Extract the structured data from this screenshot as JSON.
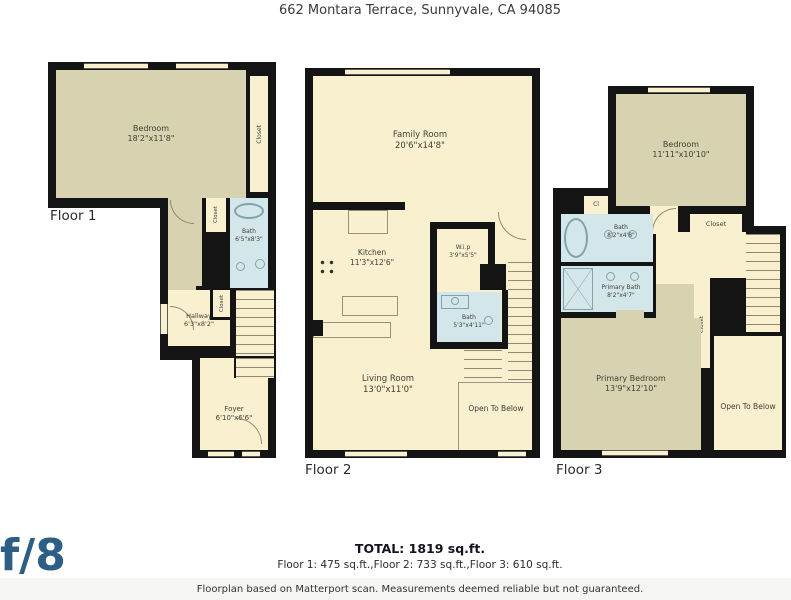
{
  "title": "662 Montara Terrace, Sunnyvale, CA 94085",
  "floor1": {
    "label": "Floor 1",
    "bedroom": {
      "name": "Bedroom",
      "dims": "18'2\"x11'8\""
    },
    "closet_right": "Closet",
    "closet_mid": "Closet",
    "bath": {
      "name": "Bath",
      "dims": "6'5\"x8'3\""
    },
    "hallway": {
      "name": "Hallway",
      "dims": "6'3\"x8'2\""
    },
    "closet_hall": "Closet",
    "foyer": {
      "name": "Foyer",
      "dims": "6'10\"x6'6\""
    }
  },
  "floor2": {
    "label": "Floor 2",
    "family_room": {
      "name": "Family Room",
      "dims": "20'6\"x14'8\""
    },
    "kitchen": {
      "name": "Kitchen",
      "dims": "11'3\"x12'6\""
    },
    "wip": {
      "name": "W.i.p",
      "dims": "3'9\"x5'5\""
    },
    "bath": {
      "name": "Bath",
      "dims": "5'3\"x4'11\""
    },
    "living_room": {
      "name": "Living Room",
      "dims": "13'0\"x11'0\""
    },
    "open_to_below": "Open To Below"
  },
  "floor3": {
    "label": "Floor 3",
    "bedroom": {
      "name": "Bedroom",
      "dims": "11'11\"x10'10\""
    },
    "cl": "Cl",
    "closet_top": "Closet",
    "bath": {
      "name": "Bath",
      "dims": "8'2\"x4'8\""
    },
    "primary_bath": {
      "name": "Primary Bath",
      "dims": "8'2\"x4'7\""
    },
    "closet_strip": "Closet",
    "primary_bedroom": {
      "name": "Primary Bedroom",
      "dims": "13'9\"x12'10\""
    },
    "open_to_below": "Open To Below"
  },
  "summary": {
    "total": "TOTAL: 1819 sq.ft.",
    "per_floor": "Floor 1: 475 sq.ft.,Floor 2: 733 sq.ft.,Floor 3: 610 sq.ft."
  },
  "footer": {
    "logo": "f/8",
    "disclaimer": "Floorplan based on Matterport scan. Measurements deemed reliable but not guaranteed."
  },
  "colors": {
    "wall": "#141414",
    "room_cream": "#f8f0cf",
    "room_olive": "#d7d3b0",
    "room_bath_blue": "#d3e7ea",
    "logo_blue": "#2d5e86"
  }
}
